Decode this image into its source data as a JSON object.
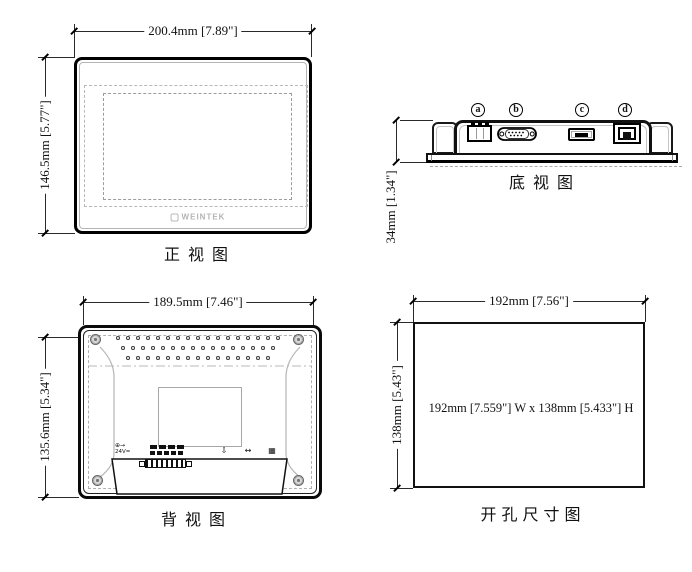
{
  "views": {
    "front": {
      "caption": "正视图",
      "width_dim": "200.4mm [7.89\"]",
      "height_dim": "146.5mm [5.77\"]",
      "logo": "WEINTEK"
    },
    "bottom": {
      "caption": "底视图",
      "height_dim": "34mm [1.34\"]",
      "ports": [
        {
          "label": "a",
          "name": "power-terminal"
        },
        {
          "label": "b",
          "name": "serial-db9-port"
        },
        {
          "label": "c",
          "name": "usb-port"
        },
        {
          "label": "d",
          "name": "ethernet-port"
        }
      ]
    },
    "back": {
      "caption": "背视图",
      "width_dim": "189.5mm [7.46\"]",
      "height_dim": "135.6mm [5.34\"]",
      "markings": {
        "power_icon": "⊕→",
        "voltage": "24V=",
        "usb_icon": "⇩",
        "com_icon": "↔",
        "lan_icon": "▦"
      }
    },
    "cutout": {
      "caption": "开孔尺寸图",
      "width_dim": "192mm [7.56\"]",
      "height_dim": "138mm [5.43\"]",
      "note": "192mm [7.559\"] W x 138mm [5.433\"] H"
    }
  }
}
